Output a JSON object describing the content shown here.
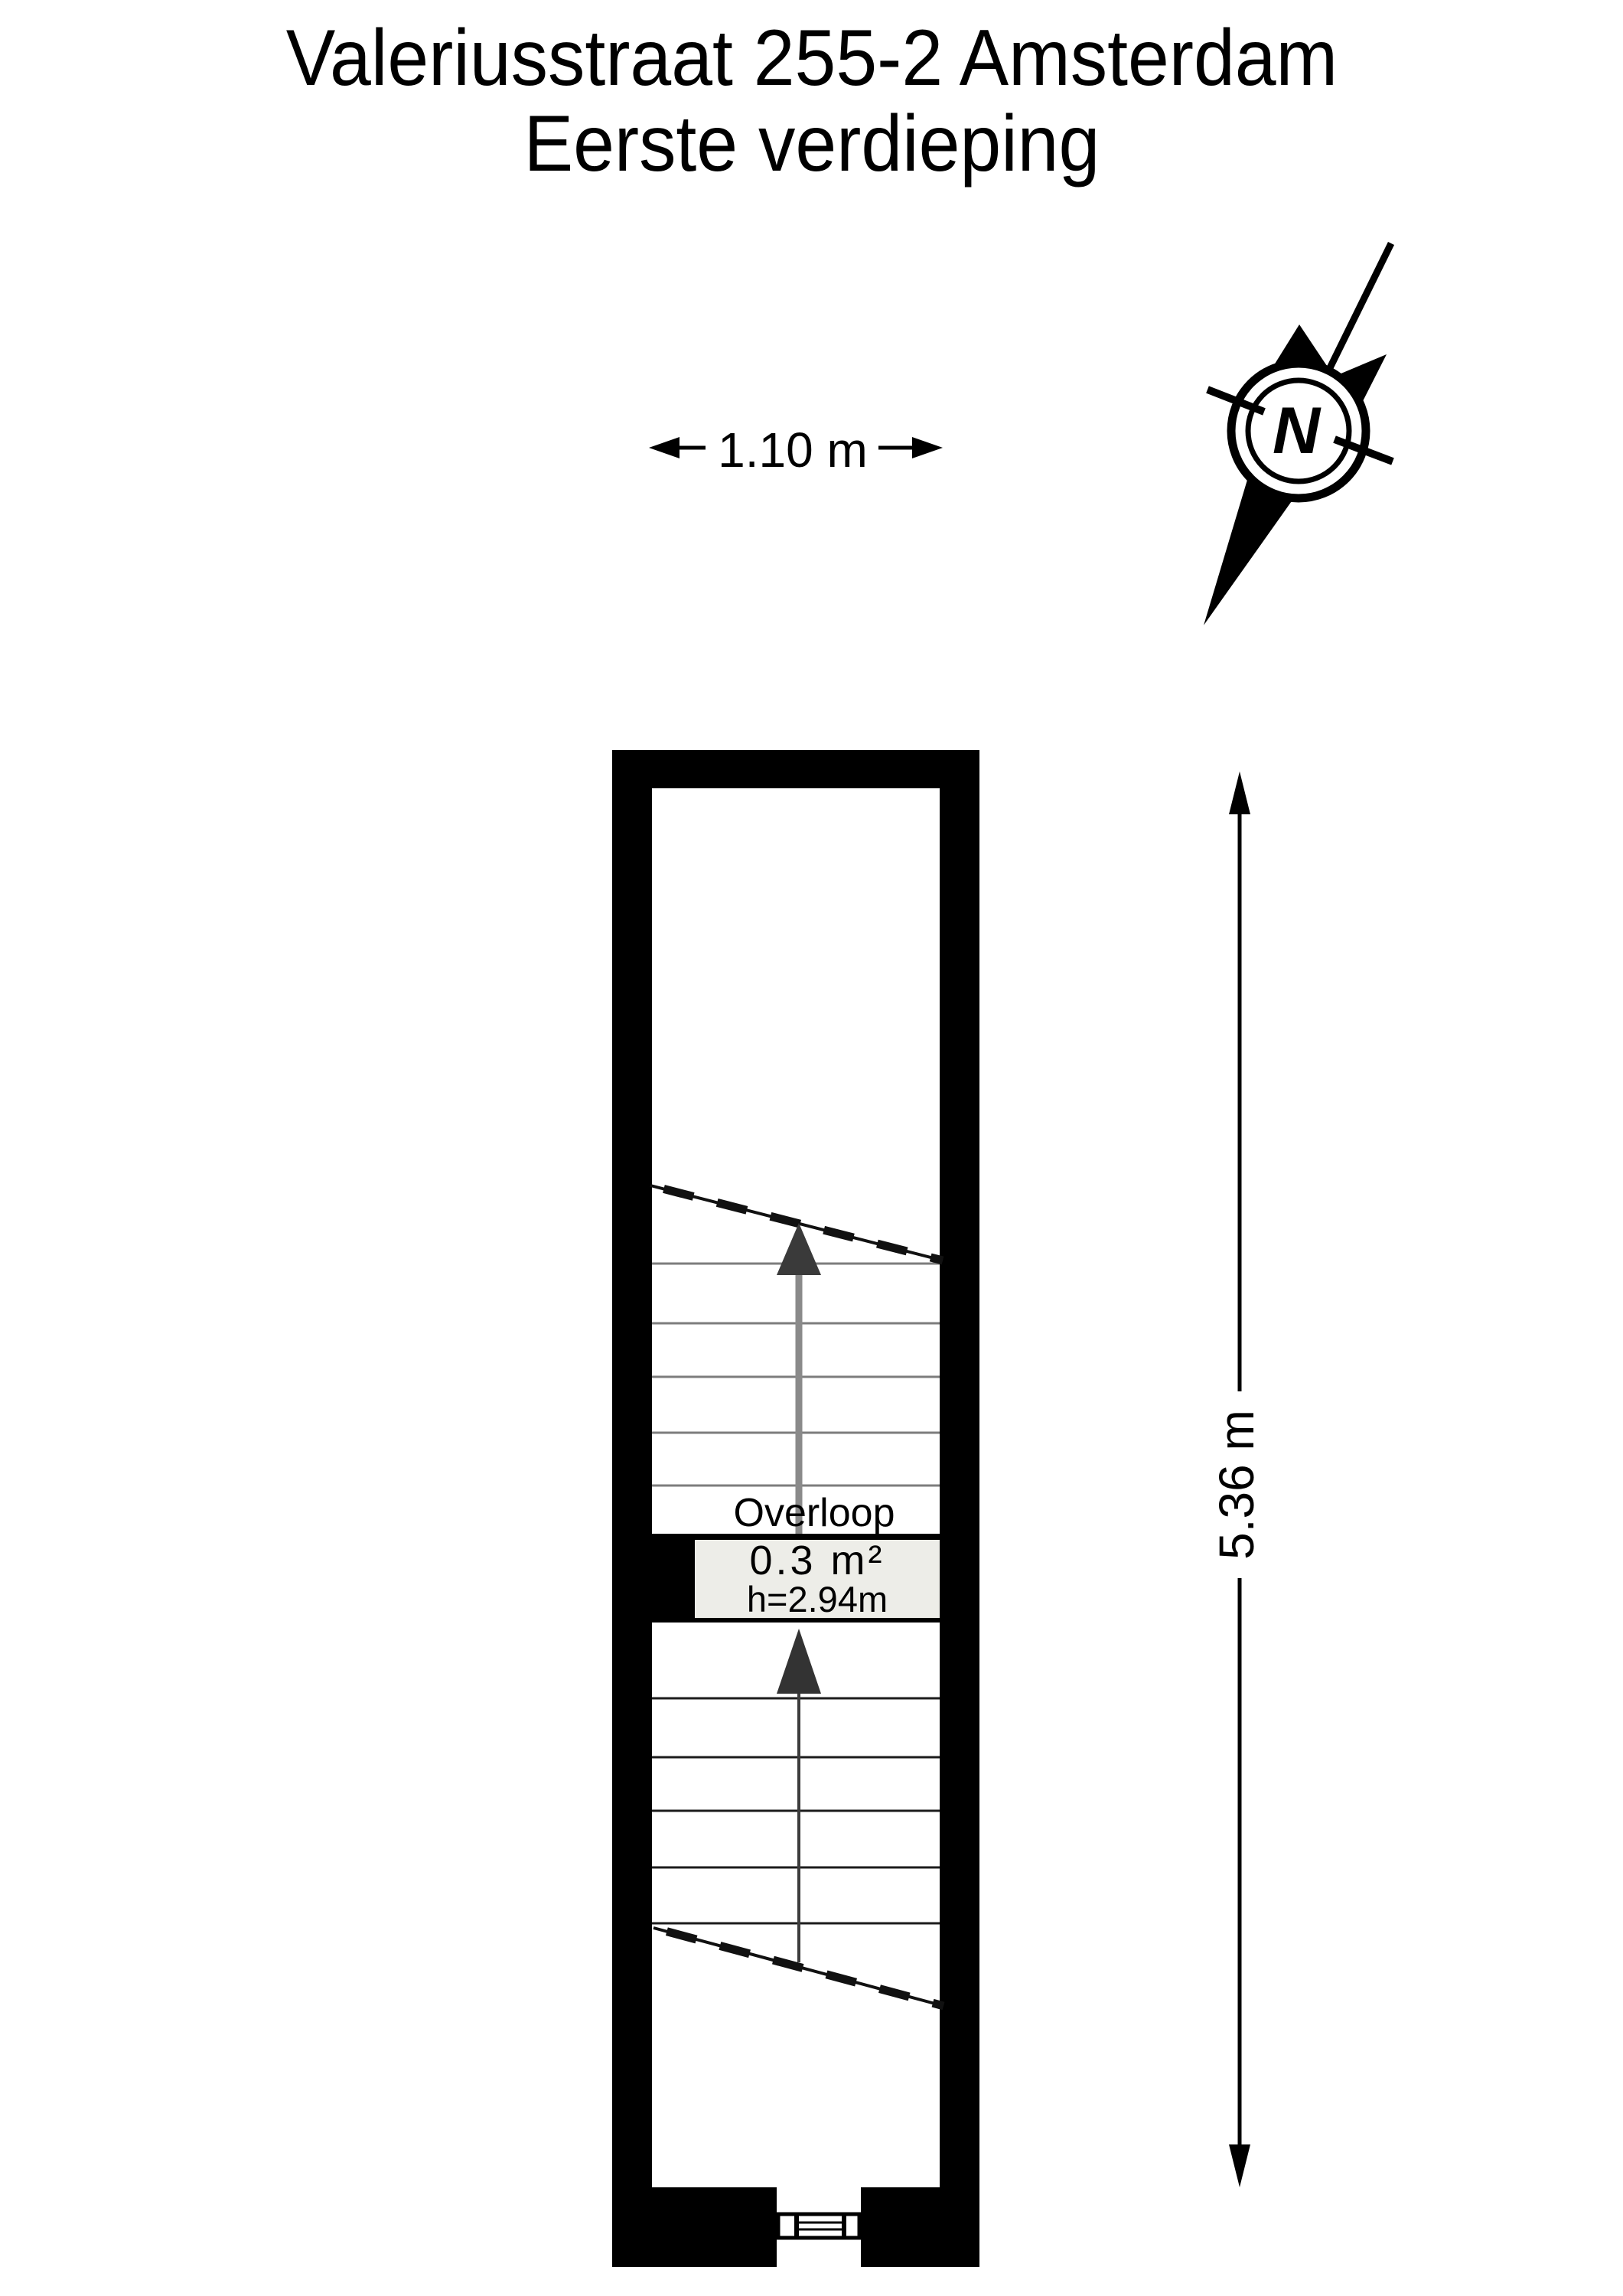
{
  "title": {
    "line1": "Valeriusstraat 255-2 Amsterdam",
    "line2": "Eerste verdieping"
  },
  "compass": {
    "label": "N"
  },
  "dimensions": {
    "width": {
      "label": "1.10 m"
    },
    "height": {
      "label": "5.36 m"
    }
  },
  "room": {
    "name": "Overloop",
    "area": "0.3 m²",
    "ceiling_height": "h=2.94m"
  },
  "colors": {
    "wall": "#000000",
    "background": "#ffffff",
    "room_label_box": "#EDEDE8",
    "upper_tread_gray": "#7d7d7d",
    "lower_tread_dark": "#1c1c1c",
    "walk_line_gray": "#8a8a8a",
    "arrowhead_dark": "#3a3a3a"
  }
}
